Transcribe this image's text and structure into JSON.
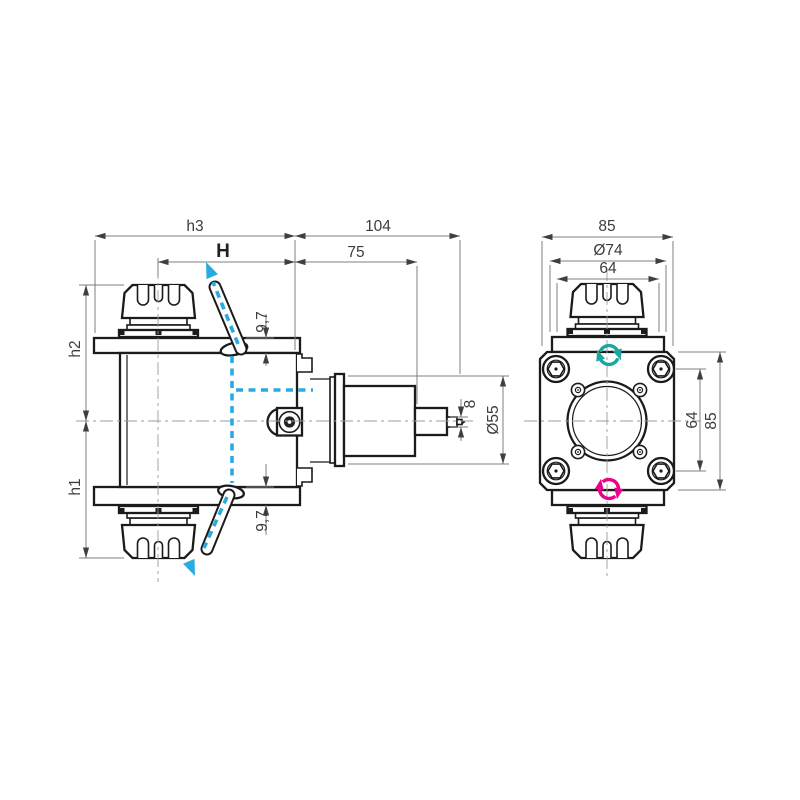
{
  "drawing": {
    "type": "technical-drawing",
    "description": "Radial driven tool holder with ER collet chucks, side view and front view with dimensions",
    "colors": {
      "outline": "#1b1b1b",
      "dimension_lines": "#7f7f7f",
      "text": "#3c3c3c",
      "coolant_blue": "#29ABE2",
      "rotation_cw_teal": "#1BA6A0",
      "rotation_ccw_magenta": "#EC008C",
      "background": "#ffffff"
    },
    "side_view": {
      "name": "side-view",
      "dims": {
        "h3": "h3",
        "len104": "104",
        "gaugeH": "H",
        "len75": "75",
        "thk_top": "9,7",
        "thk_bottom": "9,7",
        "tip8": "8",
        "dia55": "Ø55",
        "h2": "h2",
        "h1": "h1"
      }
    },
    "front_view": {
      "name": "front-view",
      "dims": {
        "w85": "85",
        "dia74": "Ø74",
        "w64": "64",
        "bolt_spacing64": "64",
        "h85": "85"
      }
    },
    "icons": {
      "rotation_cw": "rotation-cw-icon",
      "rotation_ccw": "rotation-ccw-icon",
      "coolant_up": "coolant-flow-up-arrow",
      "coolant_down": "coolant-flow-down-arrow"
    }
  }
}
